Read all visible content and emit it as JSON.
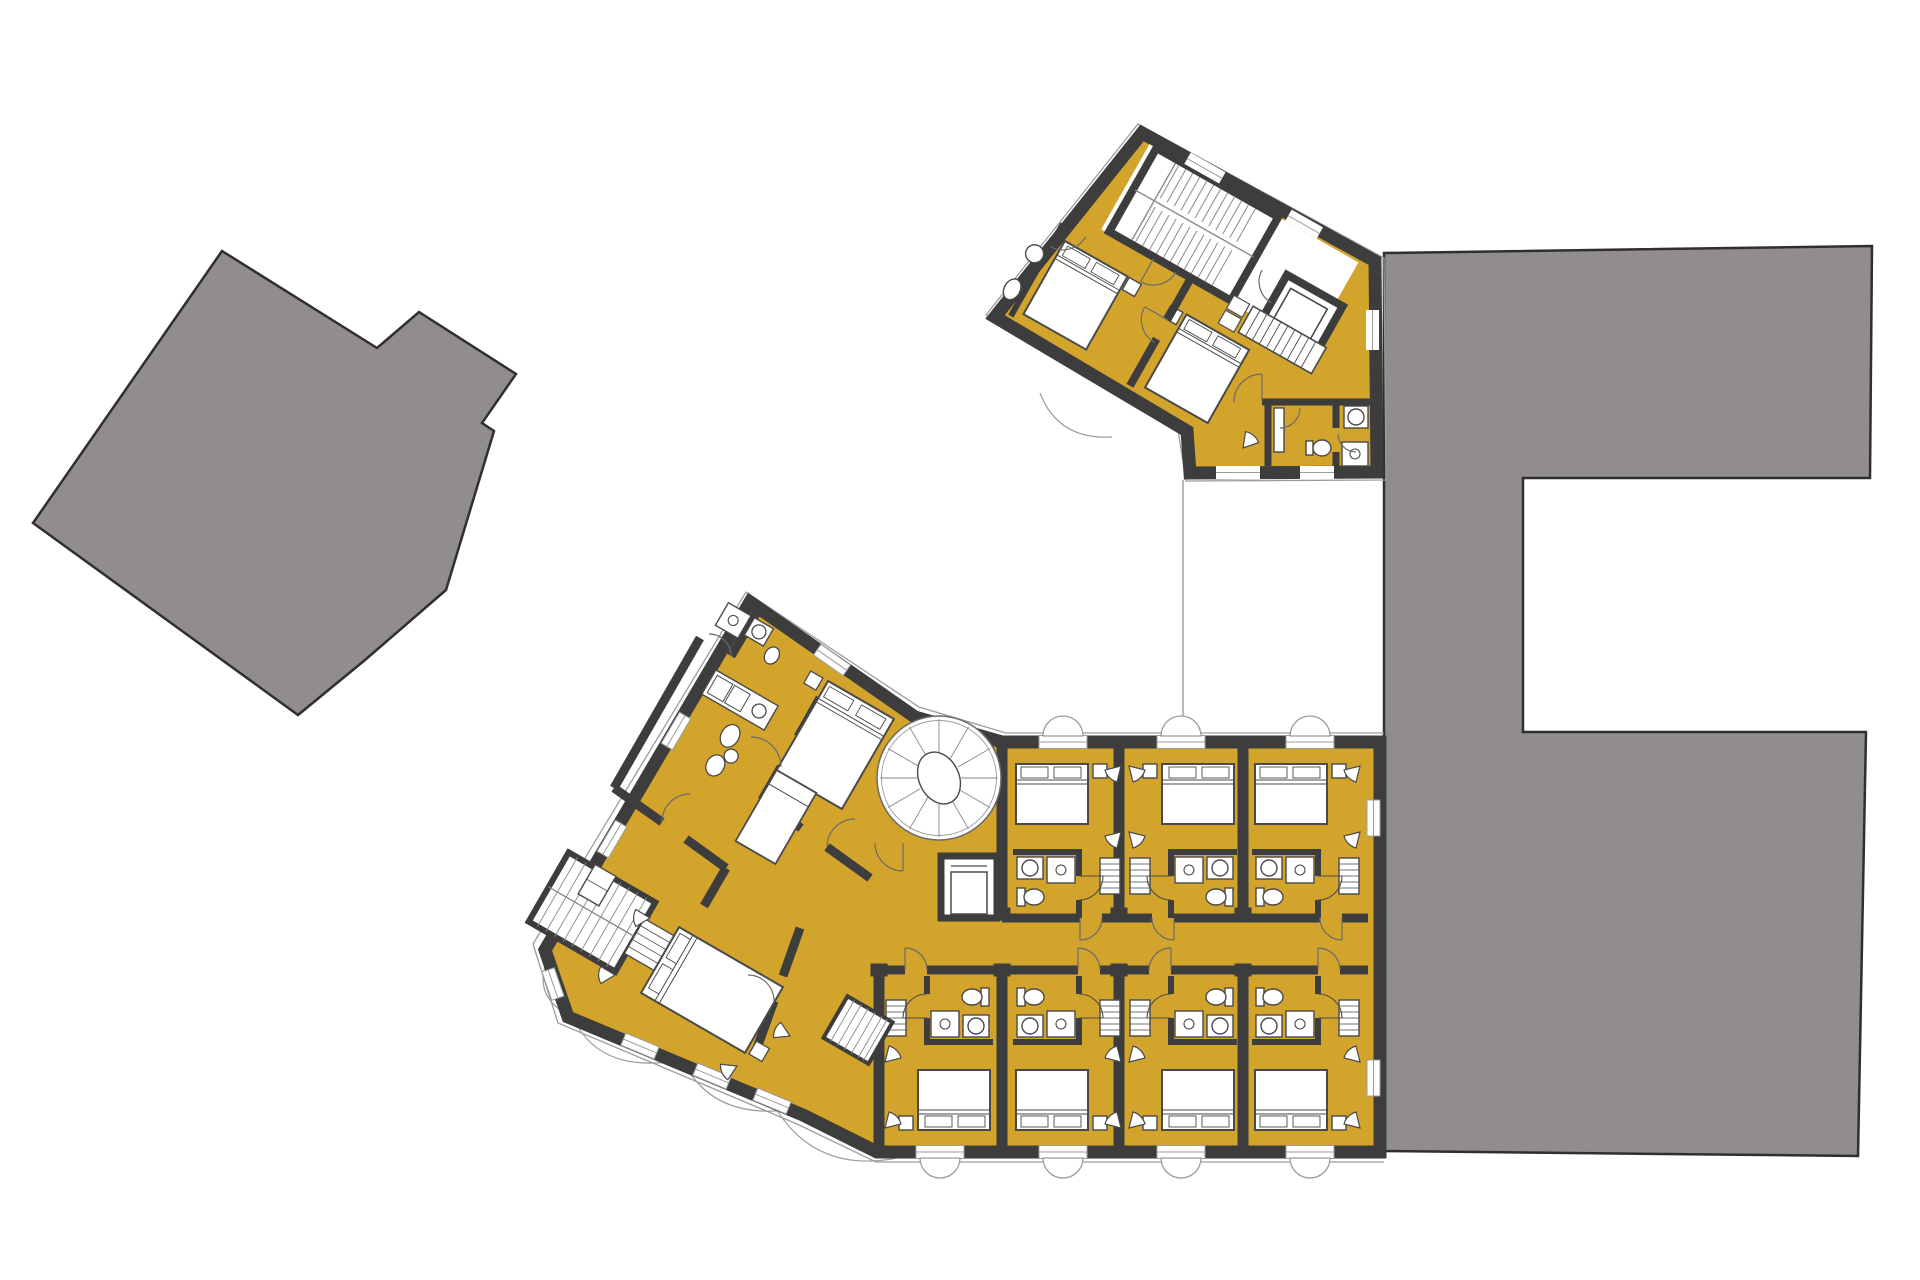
{
  "canvas": {
    "width": 1920,
    "height": 1280
  },
  "colors": {
    "background": "#ffffff",
    "floor_highlight": "#d3a42b",
    "wall": "#3d3d3d",
    "wall_edge": "#1f1f1f",
    "context_building": "#918d8d",
    "context_outline": "#2f2f2f",
    "furniture_outline": "#4a4a4a",
    "fixture_line": "#6b6b6b",
    "thin_line": "#9c9c9c",
    "stair_tread": "#8a8a8a",
    "white": "#ffffff"
  },
  "plan": {
    "type": "architectural-floor-plan",
    "highlighted_use": "guest-rooms-floor",
    "context_buildings": [
      {
        "id": "context-building-west",
        "shape": "rotated-polygon"
      },
      {
        "id": "context-building-east",
        "shape": "c-shaped-block"
      }
    ],
    "annex": {
      "rotation_deg": 29.5,
      "guest_rooms": 2,
      "stairwell": true,
      "storage_room": true,
      "bathrooms": 3
    },
    "main_building": {
      "north_row_guest_rooms": 3,
      "south_row_guest_rooms": 4,
      "wing_rooms": 4,
      "spiral_staircase": true,
      "elevator": true,
      "straight_stairs": 2,
      "corridor": true
    }
  }
}
